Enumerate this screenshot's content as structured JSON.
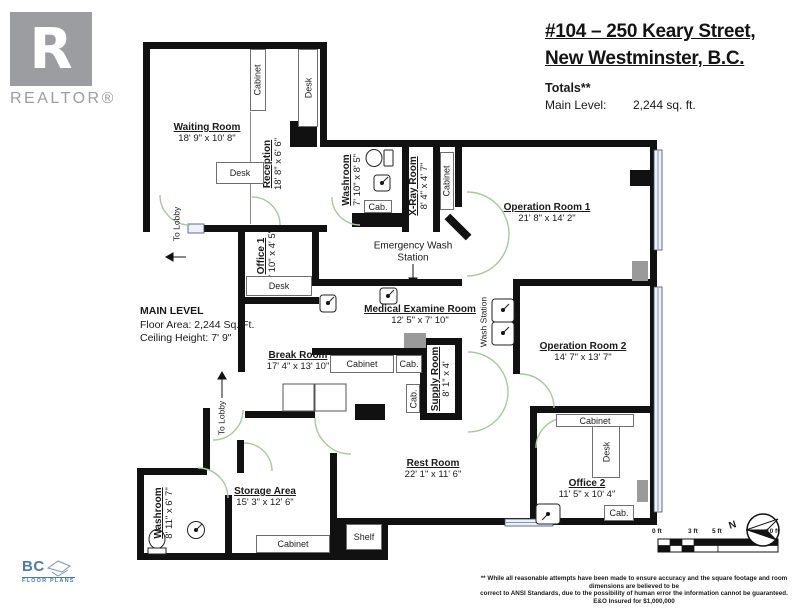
{
  "branding": {
    "realtor": {
      "logo_letter": "R",
      "label": "REALTOR®"
    },
    "bc_floor_plans": {
      "line1": "BC",
      "line2": "FLOOR PLANS"
    }
  },
  "header": {
    "address_line1": "#104 – 250 Keary Street,",
    "address_line2": "New Westminster, B.C.",
    "totals_label": "Totals**",
    "main_level_label": "Main Level:",
    "main_level_value": "2,244 sq. ft."
  },
  "level_info": {
    "title": "MAIN LEVEL",
    "floor_area": "Floor Area: 2,244 Sq. Ft.",
    "ceiling_height": "Ceiling Height: 7' 9\""
  },
  "rooms": [
    {
      "name": "Waiting Room",
      "dims": "18' 9\" x 10' 8\""
    },
    {
      "name": "Reception",
      "dims": "18' 8\" x 6' 6\""
    },
    {
      "name": "Washroom",
      "dims": "7' 10\" x 8' 5\""
    },
    {
      "name": "X-Ray Room",
      "dims": "8' 4\" x 4' 7\""
    },
    {
      "name": "Operation Room 1",
      "dims": "21' 8\" x 14' 2\""
    },
    {
      "name": "Office 1",
      "dims": "6' 10\" x 4' 5\""
    },
    {
      "name": "Medical Examine Room",
      "dims": "12' 5\" x 7' 10\""
    },
    {
      "name": "Break Room",
      "dims": "17' 4\" x 13' 10\""
    },
    {
      "name": "Supply Room",
      "dims": "8' 1\" x 4'"
    },
    {
      "name": "Operation Room 2",
      "dims": "14' 7\" x 13' 7\""
    },
    {
      "name": "Rest Room",
      "dims": "22' 1\" x 11' 6\""
    },
    {
      "name": "Office 2",
      "dims": "11' 5\" x 10' 4\""
    },
    {
      "name": "Storage Area",
      "dims": "15' 3\" x 12' 6\""
    },
    {
      "name": "Washroom",
      "dims": "8' 11\" x 6' 7\""
    }
  ],
  "furniture_labels": {
    "cabinet": "Cabinet",
    "desk": "Desk",
    "cab": "Cab.",
    "shelf": "Shelf"
  },
  "annotations": {
    "emergency_wash_line1": "Emergency Wash",
    "emergency_wash_line2": "Station",
    "wash_station": "Wash Station",
    "to_lobby": "To Lobby"
  },
  "compass": {
    "north": "N"
  },
  "scale_bar": {
    "ticks": [
      "0 ft",
      "3 ft",
      "5 ft",
      "10 ft"
    ]
  },
  "footer": {
    "disclaimer_line1": "** While all reasonable attempts have been made to ensure accuracy and the square footage and room dimensions are believed to be",
    "disclaimer_line2": "correct to ANSI Standards, due to the possibility of human error the information cannot be guaranteed. E&O Insured for $1,000,000"
  },
  "colors": {
    "wall": "#111111",
    "door_arc": "#a9c89e",
    "accent_blue": "#4a7ab5",
    "logo_gray": "#9b9da0"
  }
}
